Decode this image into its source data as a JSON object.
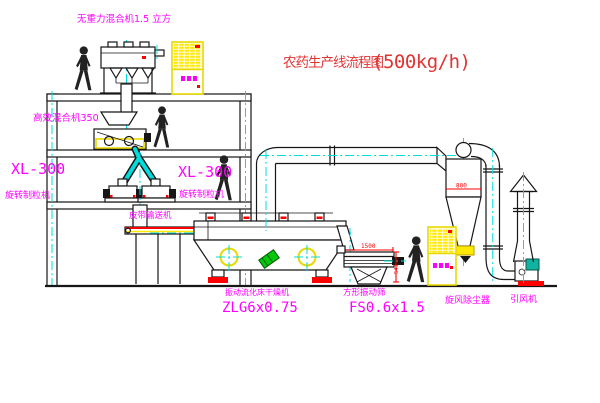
{
  "diagram": {
    "title": "农药生产线流程图",
    "capacity": "(500kg/h)",
    "equipment": {
      "gravity_mixer": "无重力混合机1.5 立方",
      "high_eff_mixer": "高效混合机350",
      "granulator_left_model": "XL-300",
      "granulator_left_name": "旋转制粒机",
      "granulator_right_model": "XL-300",
      "granulator_right_name": "旋转制粒机",
      "belt_conveyor": "皮带输送机",
      "dryer_name": "振动流化床干燥机",
      "dryer_model": "ZLG6x0.75",
      "screen_name": "方形振动筛",
      "screen_model": "FS0.6x1.5",
      "cyclone": "旋风除尘器",
      "fan": "引风机"
    },
    "dimensions": {
      "cyclone_outlet": "800",
      "screen_length": "1500",
      "screen_height": "541"
    },
    "colors": {
      "label_magenta": "#ff00ff",
      "title_red": "#e03434",
      "dimension_red": "#ff0000",
      "centerline_cyan": "#00dcdc",
      "cabinet_yellow": "#ffe900",
      "line_black": "#161616",
      "motor_green": "#00c80a"
    }
  }
}
